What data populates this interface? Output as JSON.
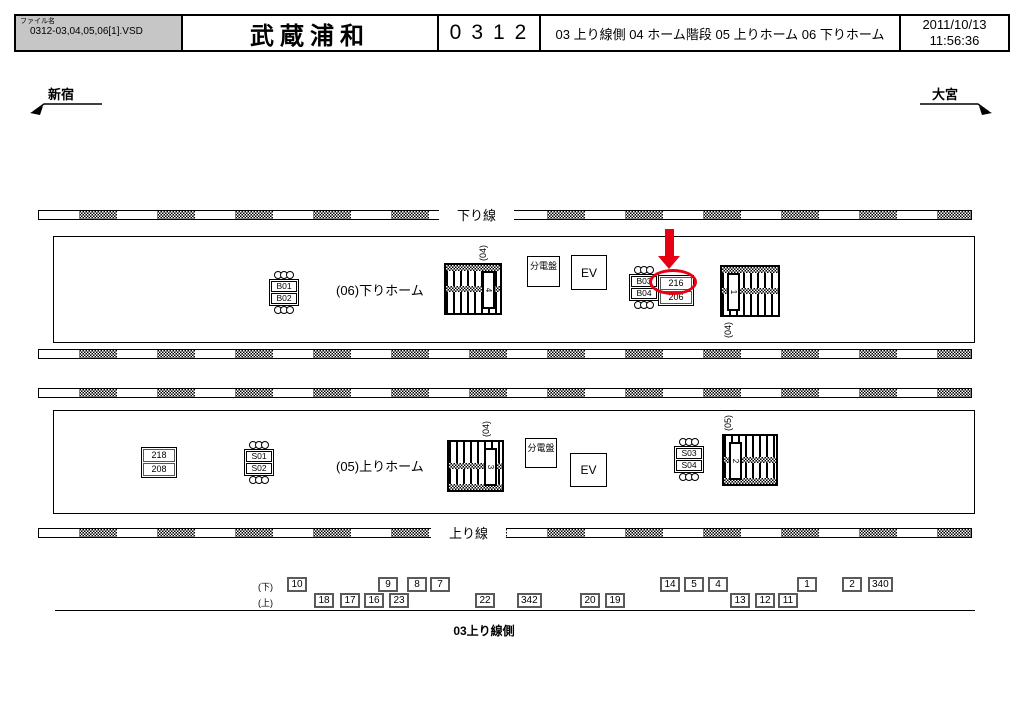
{
  "header": {
    "file_label": "ファイル名",
    "file_name": "0312-03,04,05,06[1].VSD",
    "station": "武蔵浦和",
    "code": "0312",
    "sheets": "03 上り線側 04 ホーム階段 05 上りホーム 06 下りホーム",
    "date": "2011/10/13",
    "time": "11:56:36"
  },
  "nav": {
    "left_station": "新宿",
    "right_station": "大宮"
  },
  "tracks": {
    "down_label": "下り線",
    "up_label": "上り線"
  },
  "platform_down": {
    "name": "(06)下りホーム",
    "ad_sign_1": [
      "B01",
      "B02"
    ],
    "ad_sign_2": [
      "B03",
      "B04"
    ],
    "board": [
      "216",
      "206"
    ],
    "breaker": "分電盤",
    "elevator": "EV",
    "stair_left_label": "(04)",
    "stair_left_num": "4",
    "stair_right_label": "(04)",
    "stair_right_num": "1"
  },
  "platform_up": {
    "name": "(05)上りホーム",
    "board": [
      "218",
      "208"
    ],
    "ad_sign_1": [
      "S01",
      "S02"
    ],
    "ad_sign_2": [
      "S03",
      "S04"
    ],
    "breaker": "分電盤",
    "elevator": "EV",
    "stair_left_label": "(04)",
    "stair_left_num": "3",
    "stair_right_label": "(05)",
    "stair_right_num": "2"
  },
  "bottom": {
    "row_down_label": "(下)",
    "row_up_label": "(上)",
    "boxes_down": [
      {
        "label": "10",
        "x": 287
      },
      {
        "label": "9",
        "x": 378
      },
      {
        "label": "8",
        "x": 407
      },
      {
        "label": "7",
        "x": 430
      },
      {
        "label": "14",
        "x": 660
      },
      {
        "label": "5",
        "x": 684
      },
      {
        "label": "4",
        "x": 708
      },
      {
        "label": "1",
        "x": 797
      },
      {
        "label": "2",
        "x": 842
      },
      {
        "label": "340",
        "x": 868
      }
    ],
    "boxes_up": [
      {
        "label": "18",
        "x": 314
      },
      {
        "label": "17",
        "x": 340
      },
      {
        "label": "16",
        "x": 364
      },
      {
        "label": "23",
        "x": 389
      },
      {
        "label": "22",
        "x": 475
      },
      {
        "label": "342",
        "x": 517
      },
      {
        "label": "20",
        "x": 580
      },
      {
        "label": "19",
        "x": 605
      },
      {
        "label": "13",
        "x": 730
      },
      {
        "label": "12",
        "x": 755
      },
      {
        "label": "11",
        "x": 778
      }
    ],
    "caption": "03上り線側"
  },
  "annotation": {
    "highlight_color": "#e60012"
  }
}
